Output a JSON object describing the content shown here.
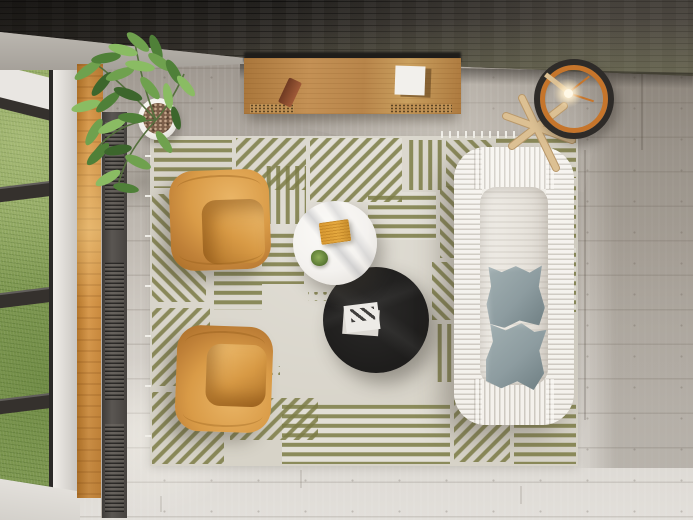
{
  "scene": {
    "type": "3d-render-top-view",
    "room": "living-room",
    "description": "Top-down view of a modern living room interior: a white pleated-fabric sofa with two gray cushions, two tan leather armchairs, a round white marble coffee table and a round black marble coffee table on a cream rug with olive-green striped patchwork pattern, a wooden sideboard against a dark brick wall, a ring floor lamp on a wooden tripod stool, a green potted plant, and a tall window with black mullions overlooking grass; light wood plank flooring."
  },
  "objects": {
    "wall": {
      "label": "dark brick wall"
    },
    "lintel": {
      "label": "concrete window lintel"
    },
    "window": {
      "label": "window with grass view and black mullions"
    },
    "sill": {
      "label": "wooden window sill"
    },
    "radiator": {
      "label": "floor radiator grille"
    },
    "floor": {
      "label": "light wood plank floor"
    },
    "plant": {
      "label": "potted green plant"
    },
    "sideboard": {
      "label": "wooden sideboard with vents"
    },
    "book_brown": {
      "label": "brown book on sideboard"
    },
    "book_white": {
      "label": "white book on sideboard"
    },
    "lamp": {
      "label": "ring floor lamp with lit bulb"
    },
    "stool": {
      "label": "wooden tripod lamp stand"
    },
    "rug": {
      "label": "cream rug with olive striped patchwork"
    },
    "armchair_top": {
      "label": "tan leather armchair (top)"
    },
    "armchair_bottom": {
      "label": "tan leather armchair (bottom)"
    },
    "table_white": {
      "label": "round white marble coffee table"
    },
    "tray": {
      "label": "orange ribbed tray"
    },
    "succulent": {
      "label": "small succulent plant"
    },
    "table_black": {
      "label": "round black marble coffee table"
    },
    "magazine": {
      "label": "magazine with striped cover"
    },
    "sofa": {
      "label": "white pleated fabric sofa"
    },
    "pillow1": {
      "label": "gray cushion (upper)"
    },
    "pillow2": {
      "label": "gray cushion (lower)"
    },
    "sun_streak": {
      "label": "sunlight streak on floor"
    }
  },
  "colors": {
    "wall-dark": "#35322e",
    "concrete": "#bcb8b1",
    "concrete-dark": "#a19c95",
    "floor-top": "#8f8881",
    "floor-mid": "#bcb6ae",
    "floor-bottom": "#e2dfda",
    "grass": "#87a058",
    "mullion": "#35312d",
    "frame-white": "#e9e6e2",
    "sill-wood": "#d89a4e",
    "sill-wood-dark": "#b5772c",
    "radiator": "#504c48",
    "sideboard-wood": "#bb8446",
    "sideboard-dark": "#5c4423",
    "book-brown": "#8a4c2e",
    "paper-white": "#f2f0ec",
    "lamp-ring": "#2e2b28",
    "lamp-orange": "#c6752b",
    "stool-wood": "#dcc093",
    "rug-base": "#d7d3c8",
    "rug-light": "#e2dfd6",
    "rug-stripe": "#7c7c46",
    "chair-light": "#eab566",
    "chair-main": "#d99b47",
    "chair-dark": "#a96d27",
    "marble-white": "#f4f2ef",
    "tray-orange": "#e5a93f",
    "succulent": "#5f7e37",
    "table-black": "#1e1d1c",
    "magazine-stripe": "#413f3d",
    "sofa-white": "#edeae4",
    "pillow": "#8d9ca0",
    "pillow-dark": "#6f7f83",
    "plant-green": "#4f8038",
    "plant-light": "#8abc63",
    "plant-dark": "#3c662c",
    "pot-white": "#f0eee9",
    "soil": "#7b5e49"
  }
}
